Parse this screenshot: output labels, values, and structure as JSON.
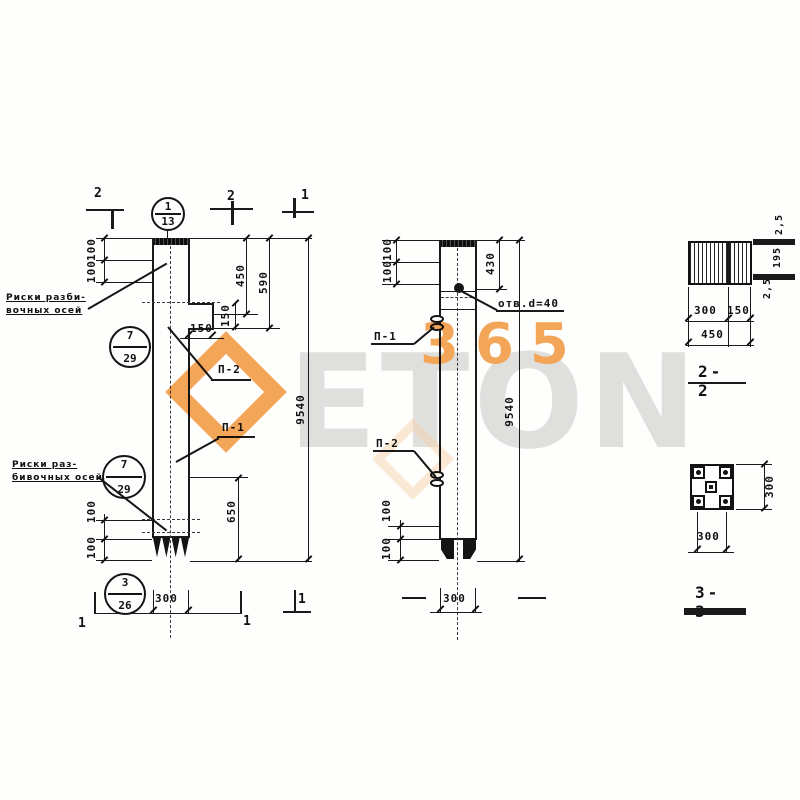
{
  "watermark": {
    "gray_text": "ETON",
    "orange_text": "365",
    "orange": "#f2973b",
    "gray": "#dbdbdb"
  },
  "notes": {
    "axes_note_top_l1": "Риски разби-",
    "axes_note_top_l2": "вочных осей",
    "axes_note_bottom_l1": "Риски раз-",
    "axes_note_bottom_l2": "бивочных осей",
    "hole_label": "отв.d=40"
  },
  "callouts": {
    "c1_top": "1",
    "c1_bottom": "13",
    "c2_top": "7",
    "c2_bottom": "29",
    "c3_top": "7",
    "c3_bottom": "29",
    "c4_top": "3",
    "c4_bottom": "26"
  },
  "section_marks": {
    "top_left": "2",
    "top_mid": "2",
    "top_right": "1",
    "bottom_left": "1",
    "bottom_mid": "1",
    "bottom_right": "1"
  },
  "loop_labels": {
    "front_upper": "П-2",
    "front_lower": "П-1",
    "side_upper": "П-1",
    "side_lower": "П-2"
  },
  "front_view": {
    "dim_100_a": "100",
    "dim_100_b": "100",
    "dim_450": "450",
    "dim_590": "590",
    "dim_150_v": "150",
    "dim_150_h": "150",
    "dim_650": "650",
    "dim_total": "9540",
    "dim_100_c": "100",
    "dim_100_d": "100",
    "dim_width": "300"
  },
  "side_view": {
    "dim_100_a": "100",
    "dim_100_b": "100",
    "dim_430": "430",
    "dim_total": "9540",
    "dim_100_c": "100",
    "dim_100_d": "100",
    "dim_width": "300"
  },
  "section_2_2": {
    "title": "2-2",
    "dim_300": "300",
    "dim_150": "150",
    "dim_450": "450",
    "edge_top": "2,5",
    "edge_mid": "195",
    "edge_bottom": "2,5"
  },
  "section_3_3": {
    "title": "3-3",
    "dim_width": "300",
    "dim_height": "300"
  }
}
